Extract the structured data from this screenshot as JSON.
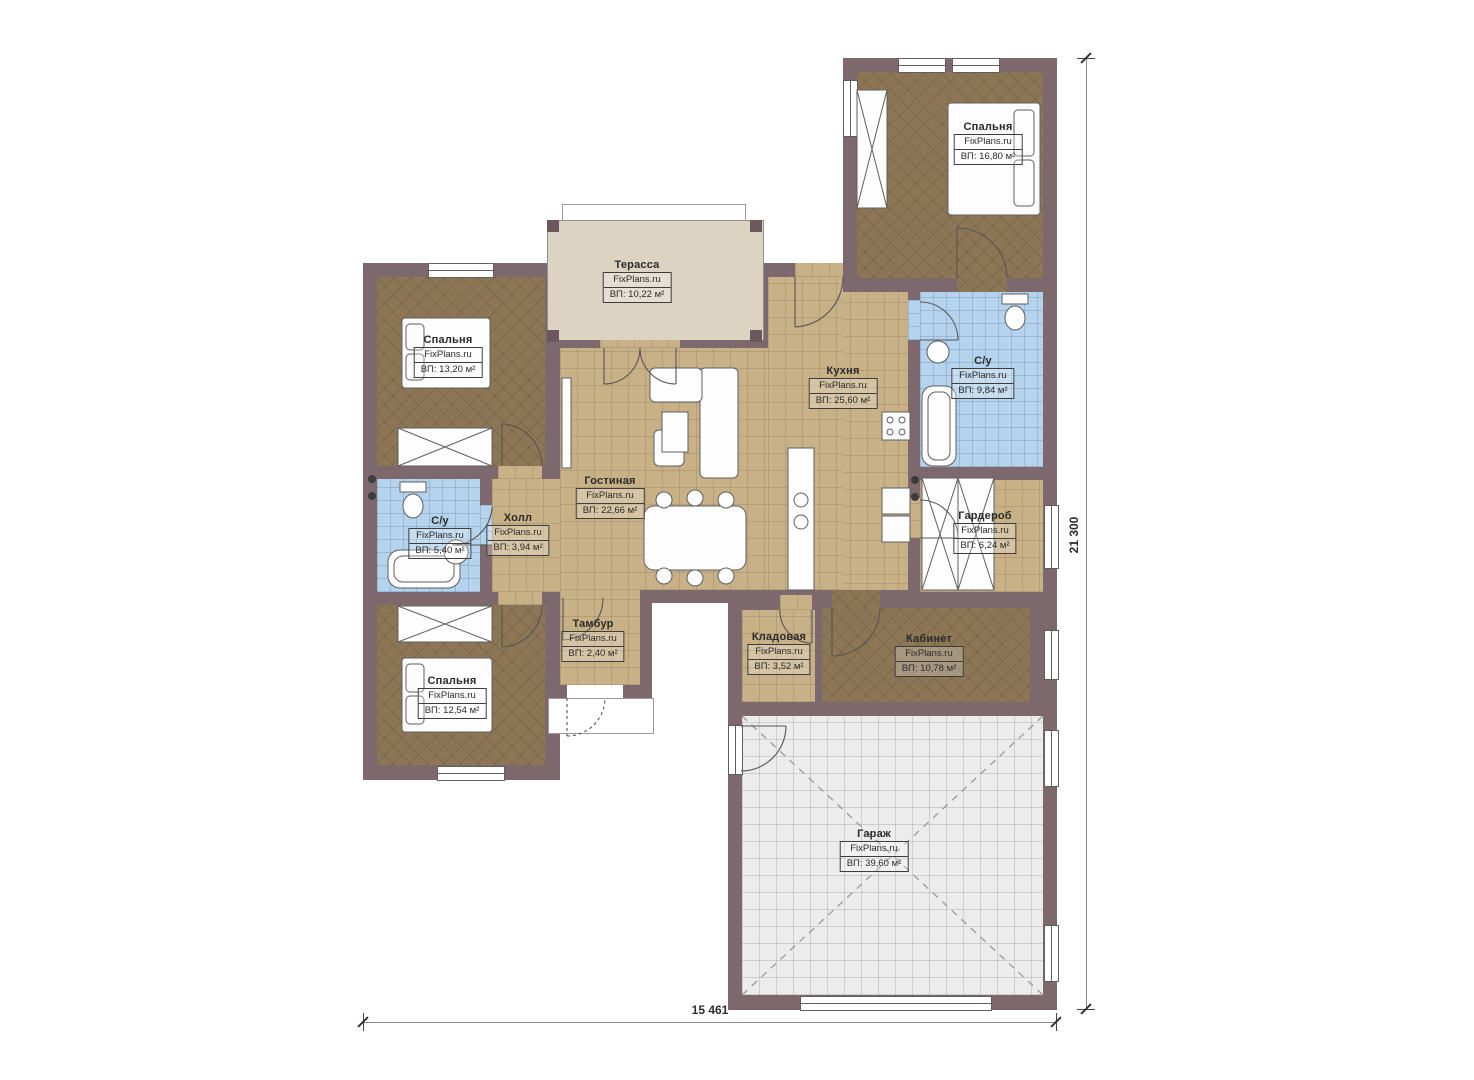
{
  "watermark": "FixPlans.ru",
  "dimensions": {
    "width_label": "15 461",
    "height_label": "21 300"
  },
  "colors": {
    "wall": "#7d686d",
    "floor_wood": "#8c7656",
    "floor_tile": "#c9b187",
    "floor_bath": "#b5d3ec",
    "floor_terrace": "#ddd3c3",
    "floor_garage": "#ececec"
  },
  "rooms": [
    {
      "id": "bedroom-top-right",
      "name": "Спальня",
      "brand": "FixPlans.ru",
      "area": "ВП: 16,80 м²"
    },
    {
      "id": "bedroom-left-top",
      "name": "Спальня",
      "brand": "FixPlans.ru",
      "area": "ВП: 13,20 м²"
    },
    {
      "id": "terrace",
      "name": "Терасса",
      "brand": "FixPlans.ru",
      "area": "ВП: 10,22 м²"
    },
    {
      "id": "kitchen",
      "name": "Кухня",
      "brand": "FixPlans.ru",
      "area": "ВП: 25,60 м²"
    },
    {
      "id": "bathroom-right",
      "name": "С/у",
      "brand": "FixPlans.ru",
      "area": "ВП: 9,84 м²"
    },
    {
      "id": "living-room",
      "name": "Гостиная",
      "brand": "FixPlans.ru",
      "area": "ВП: 22,66 м²"
    },
    {
      "id": "hall",
      "name": "Холл",
      "brand": "FixPlans.ru",
      "area": "ВП: 3,94 м²"
    },
    {
      "id": "bathroom-left",
      "name": "С/у",
      "brand": "FixPlans.ru",
      "area": "ВП: 5,40 м²"
    },
    {
      "id": "wardrobe",
      "name": "Гардероб",
      "brand": "FixPlans.ru",
      "area": "ВП: 6,24 м²"
    },
    {
      "id": "bedroom-left-bottom",
      "name": "Спальня",
      "brand": "FixPlans.ru",
      "area": "ВП: 12,54 м²"
    },
    {
      "id": "vestibule",
      "name": "Тамбур",
      "brand": "FixPlans.ru",
      "area": "ВП: 2,40 м²"
    },
    {
      "id": "storage",
      "name": "Кладовая",
      "brand": "FixPlans.ru",
      "area": "ВП: 3,52 м²"
    },
    {
      "id": "office",
      "name": "Кабинет",
      "brand": "FixPlans.ru",
      "area": "ВП: 10,78 м²"
    },
    {
      "id": "garage",
      "name": "Гараж",
      "brand": "FixPlans.ru",
      "area": "ВП: 39,60 м²"
    }
  ]
}
